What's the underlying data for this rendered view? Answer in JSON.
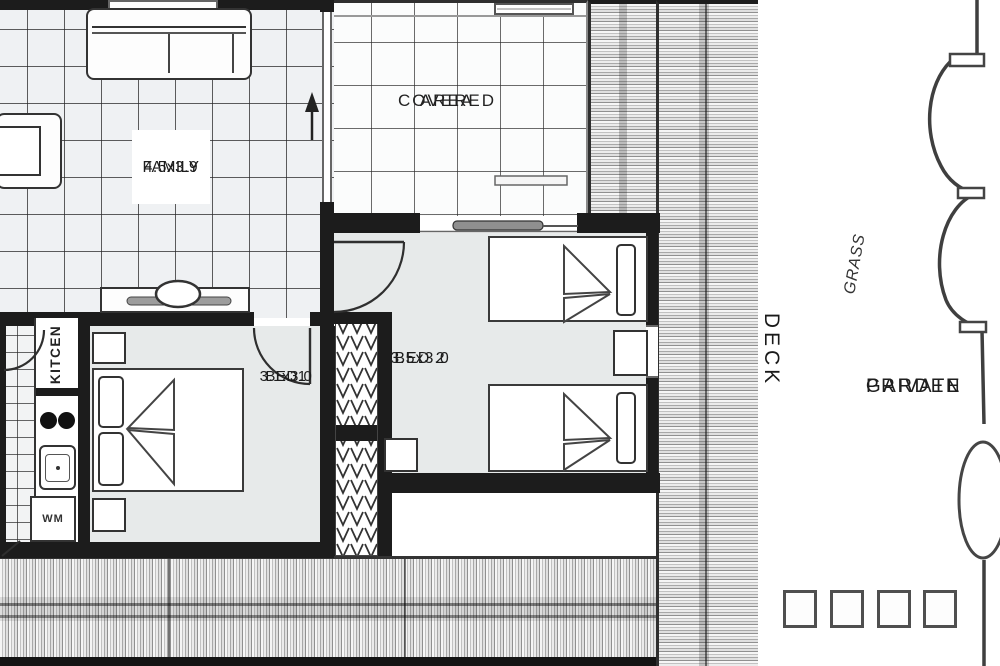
{
  "floorplan": {
    "family": {
      "dims": "4.5x3.9",
      "name": "FAMILY"
    },
    "covered_area": {
      "line1": "AREA",
      "line2": "COVERED"
    },
    "bed2": {
      "dims": "3.5x3.0",
      "name": "BED 2"
    },
    "bed1": {
      "dims": "3.1x3.0",
      "name": "BED1"
    },
    "kitchen_label": "KITCEN",
    "washing_machine_label": "WM",
    "deck_label": "DECK",
    "grass_label": "GRASS",
    "private_garden": {
      "line1": "PRIVATE",
      "line2": "GARDEN"
    }
  },
  "colors": {
    "wall": "#1c1c1c",
    "bedroom_floor": "#e7eaea",
    "deck_stripe_dark": "#909090"
  }
}
